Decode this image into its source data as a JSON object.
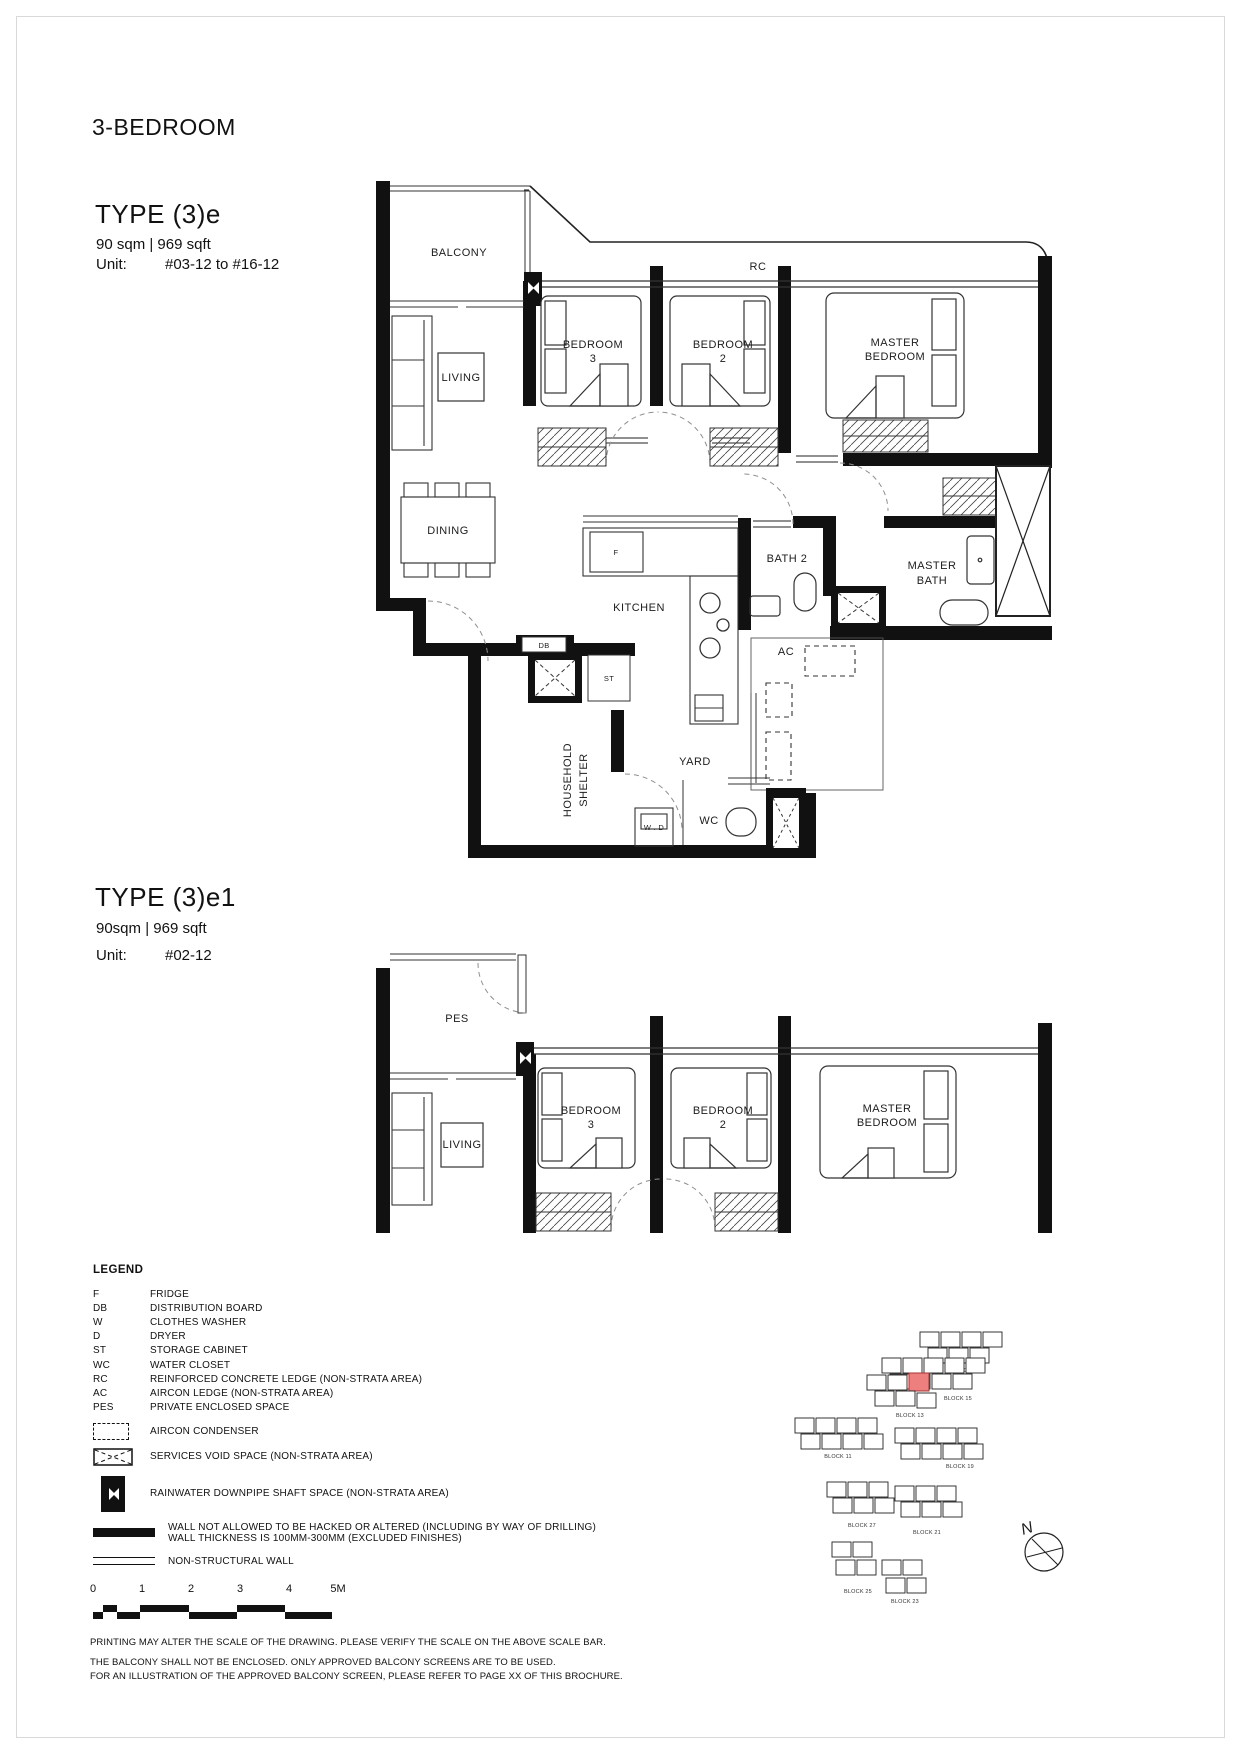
{
  "page": {
    "title": "3-BEDROOM"
  },
  "type_e": {
    "title": "TYPE (3)e",
    "area": "90 sqm | 969 sqft",
    "unit_label": "Unit:",
    "unit_value": "#03-12 to #16-12"
  },
  "type_e1": {
    "title": "TYPE (3)e1",
    "area": "90sqm | 969 sqft",
    "unit_label": "Unit:",
    "unit_value": "#02-12"
  },
  "labels": {
    "balcony": "BALCONY",
    "living": "LIVING",
    "dining": "DINING",
    "kitchen": "KITCHEN",
    "bedroom": "BEDROOM",
    "num3": "3",
    "num2": "2",
    "master": "MASTER",
    "bath2": "BATH 2",
    "bath": "BATH",
    "yard": "YARD",
    "wc": "WC",
    "household": "HOUSEHOLD",
    "shelter": "SHELTER",
    "ac": "AC",
    "rc": "RC",
    "db": "DB",
    "st": "ST",
    "fridge": "F",
    "wd": "W . D",
    "pes": "PES"
  },
  "legend": {
    "title": "LEGEND",
    "items": [
      {
        "abbr": "F",
        "desc": "FRIDGE"
      },
      {
        "abbr": "DB",
        "desc": "DISTRIBUTION BOARD"
      },
      {
        "abbr": "W",
        "desc": "CLOTHES WASHER"
      },
      {
        "abbr": "D",
        "desc": "DRYER"
      },
      {
        "abbr": "ST",
        "desc": "STORAGE CABINET"
      },
      {
        "abbr": "WC",
        "desc": "WATER CLOSET"
      },
      {
        "abbr": "RC",
        "desc": "REINFORCED CONCRETE LEDGE (NON-STRATA AREA)"
      },
      {
        "abbr": "AC",
        "desc": "AIRCON LEDGE (NON-STRATA AREA)"
      },
      {
        "abbr": "PES",
        "desc": "PRIVATE ENCLOSED SPACE"
      },
      {
        "symbol": "aircon-condenser",
        "desc": "AIRCON CONDENSER"
      },
      {
        "symbol": "services-void",
        "desc": "SERVICES VOID SPACE (NON-STRATA AREA)"
      },
      {
        "symbol": "rainwater-downpipe",
        "desc": "RAINWATER DOWNPIPE SHAFT SPACE (NON-STRATA AREA)"
      },
      {
        "symbol": "structural-wall",
        "desc": "WALL NOT ALLOWED TO BE HACKED OR ALTERED (INCLUDING BY WAY OF DRILLING)",
        "desc2": "WALL THICKNESS IS 100MM-300MM (EXCLUDED FINISHES)"
      },
      {
        "symbol": "non-structural-wall",
        "desc": "NON-STRUCTURAL WALL"
      }
    ]
  },
  "scalebar": {
    "ticks": [
      "0",
      "1",
      "2",
      "3",
      "4",
      "5M"
    ]
  },
  "sitemap": {
    "north": "N",
    "highlight_color": "#ee7f7f",
    "blocks": [
      {
        "label": "BLOCK 17"
      },
      {
        "label": "BLOCK 15"
      },
      {
        "label": "BLOCK 13"
      },
      {
        "label": "BLOCK 11"
      },
      {
        "label": "BLOCK 19"
      },
      {
        "label": "BLOCK 27"
      },
      {
        "label": "BLOCK 21"
      },
      {
        "label": "BLOCK 25"
      },
      {
        "label": "BLOCK 23"
      }
    ]
  },
  "footnotes": [
    "PRINTING MAY ALTER THE SCALE OF THE DRAWING. PLEASE VERIFY THE SCALE ON THE ABOVE SCALE BAR.",
    "THE BALCONY SHALL NOT BE ENCLOSED. ONLY APPROVED BALCONY SCREENS ARE TO BE USED.",
    "FOR AN ILLUSTRATION OF THE APPROVED BALCONY SCREEN, PLEASE REFER TO PAGE XX OF THIS BROCHURE."
  ]
}
